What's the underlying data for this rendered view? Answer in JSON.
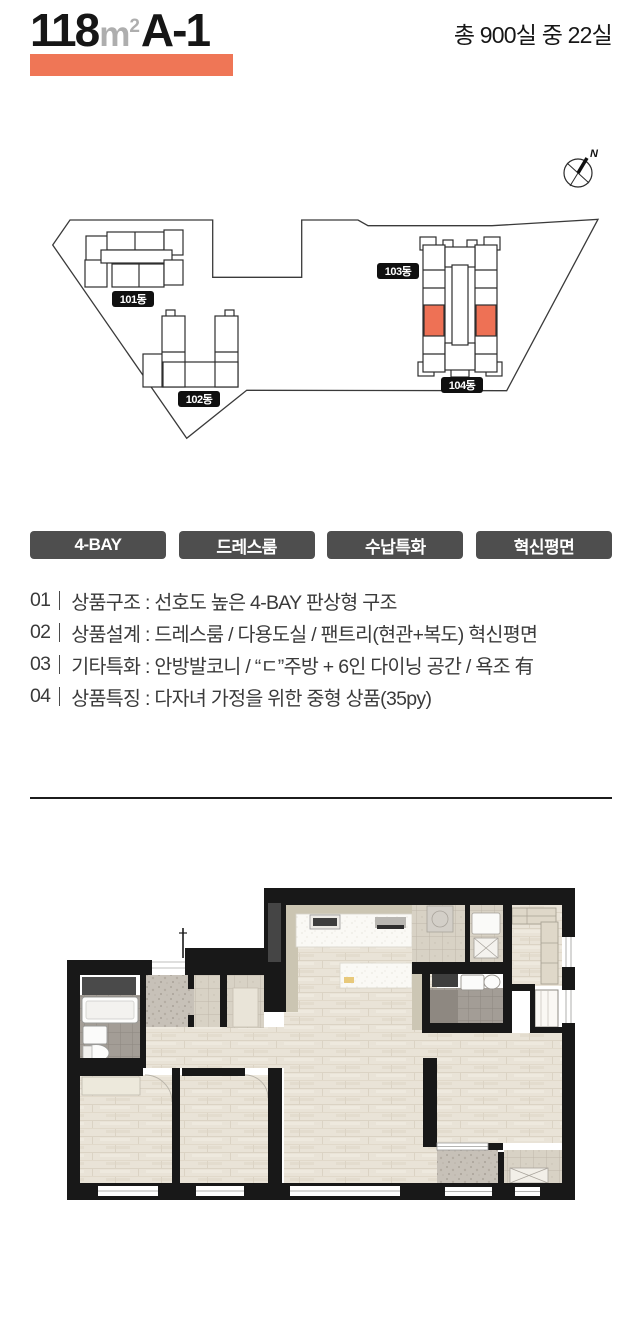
{
  "header": {
    "area": "118",
    "unit_letter": "m",
    "unit_sup": "2",
    "type": "A-1",
    "total": "총 900실 중 22실"
  },
  "site": {
    "compass": "N",
    "buildings": [
      {
        "label": "101동"
      },
      {
        "label": "102동"
      },
      {
        "label": "103동"
      },
      {
        "label": "104동"
      }
    ]
  },
  "badges": [
    "4-BAY",
    "드레스룸",
    "수납특화",
    "혁신평면"
  ],
  "features": [
    {
      "num": "01",
      "text": "상품구조 : 선호도 높은 4-BAY 판상형 구조"
    },
    {
      "num": "02",
      "text": "상품설계 : 드레스룸 / 다용도실 / 팬트리(현관+복도) 혁신평면"
    },
    {
      "num": "03",
      "text": "기타특화 : 안방발코니 / “ㄷ”주방 + 6인 다이닝 공간 / 욕조 有"
    },
    {
      "num": "04",
      "text": "상품특징 : 다자녀 가정을 위한 중형 상품(35py)"
    }
  ],
  "colors": {
    "accent": "#EF7656",
    "badge_bg": "#4E4E4E",
    "unit_highlight": "#EE7155",
    "wall": "#181818"
  }
}
